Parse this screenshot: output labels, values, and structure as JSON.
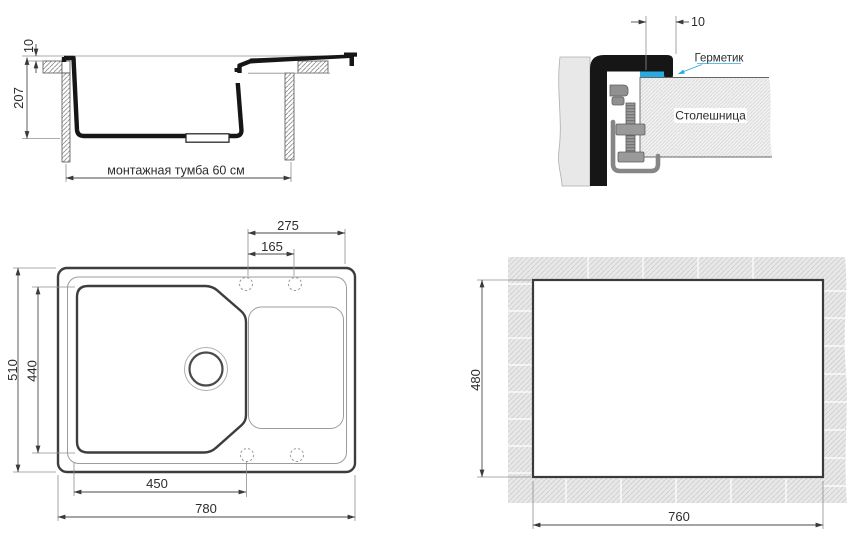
{
  "colors": {
    "accent": "#29abe2",
    "line": "#161616",
    "thin_line": "#8f8f8f",
    "hatch_bg": "#e8e8e8"
  },
  "side_section": {
    "rim_height_label": "10",
    "depth_label": "207",
    "cabinet_label": "монтажная тумба  60 см"
  },
  "mount_detail": {
    "offset_label": "10",
    "sealant_label": "Герметик",
    "countertop_label": "Столешница"
  },
  "top_view": {
    "holes_span_label": "275",
    "holes_pitch_label": "165",
    "overall_depth_label": "510",
    "bowl_depth_label": "440",
    "bowl_width_label": "450",
    "overall_width_label": "780"
  },
  "cutout_view": {
    "cutout_depth_label": "480",
    "cutout_width_label": "760"
  }
}
